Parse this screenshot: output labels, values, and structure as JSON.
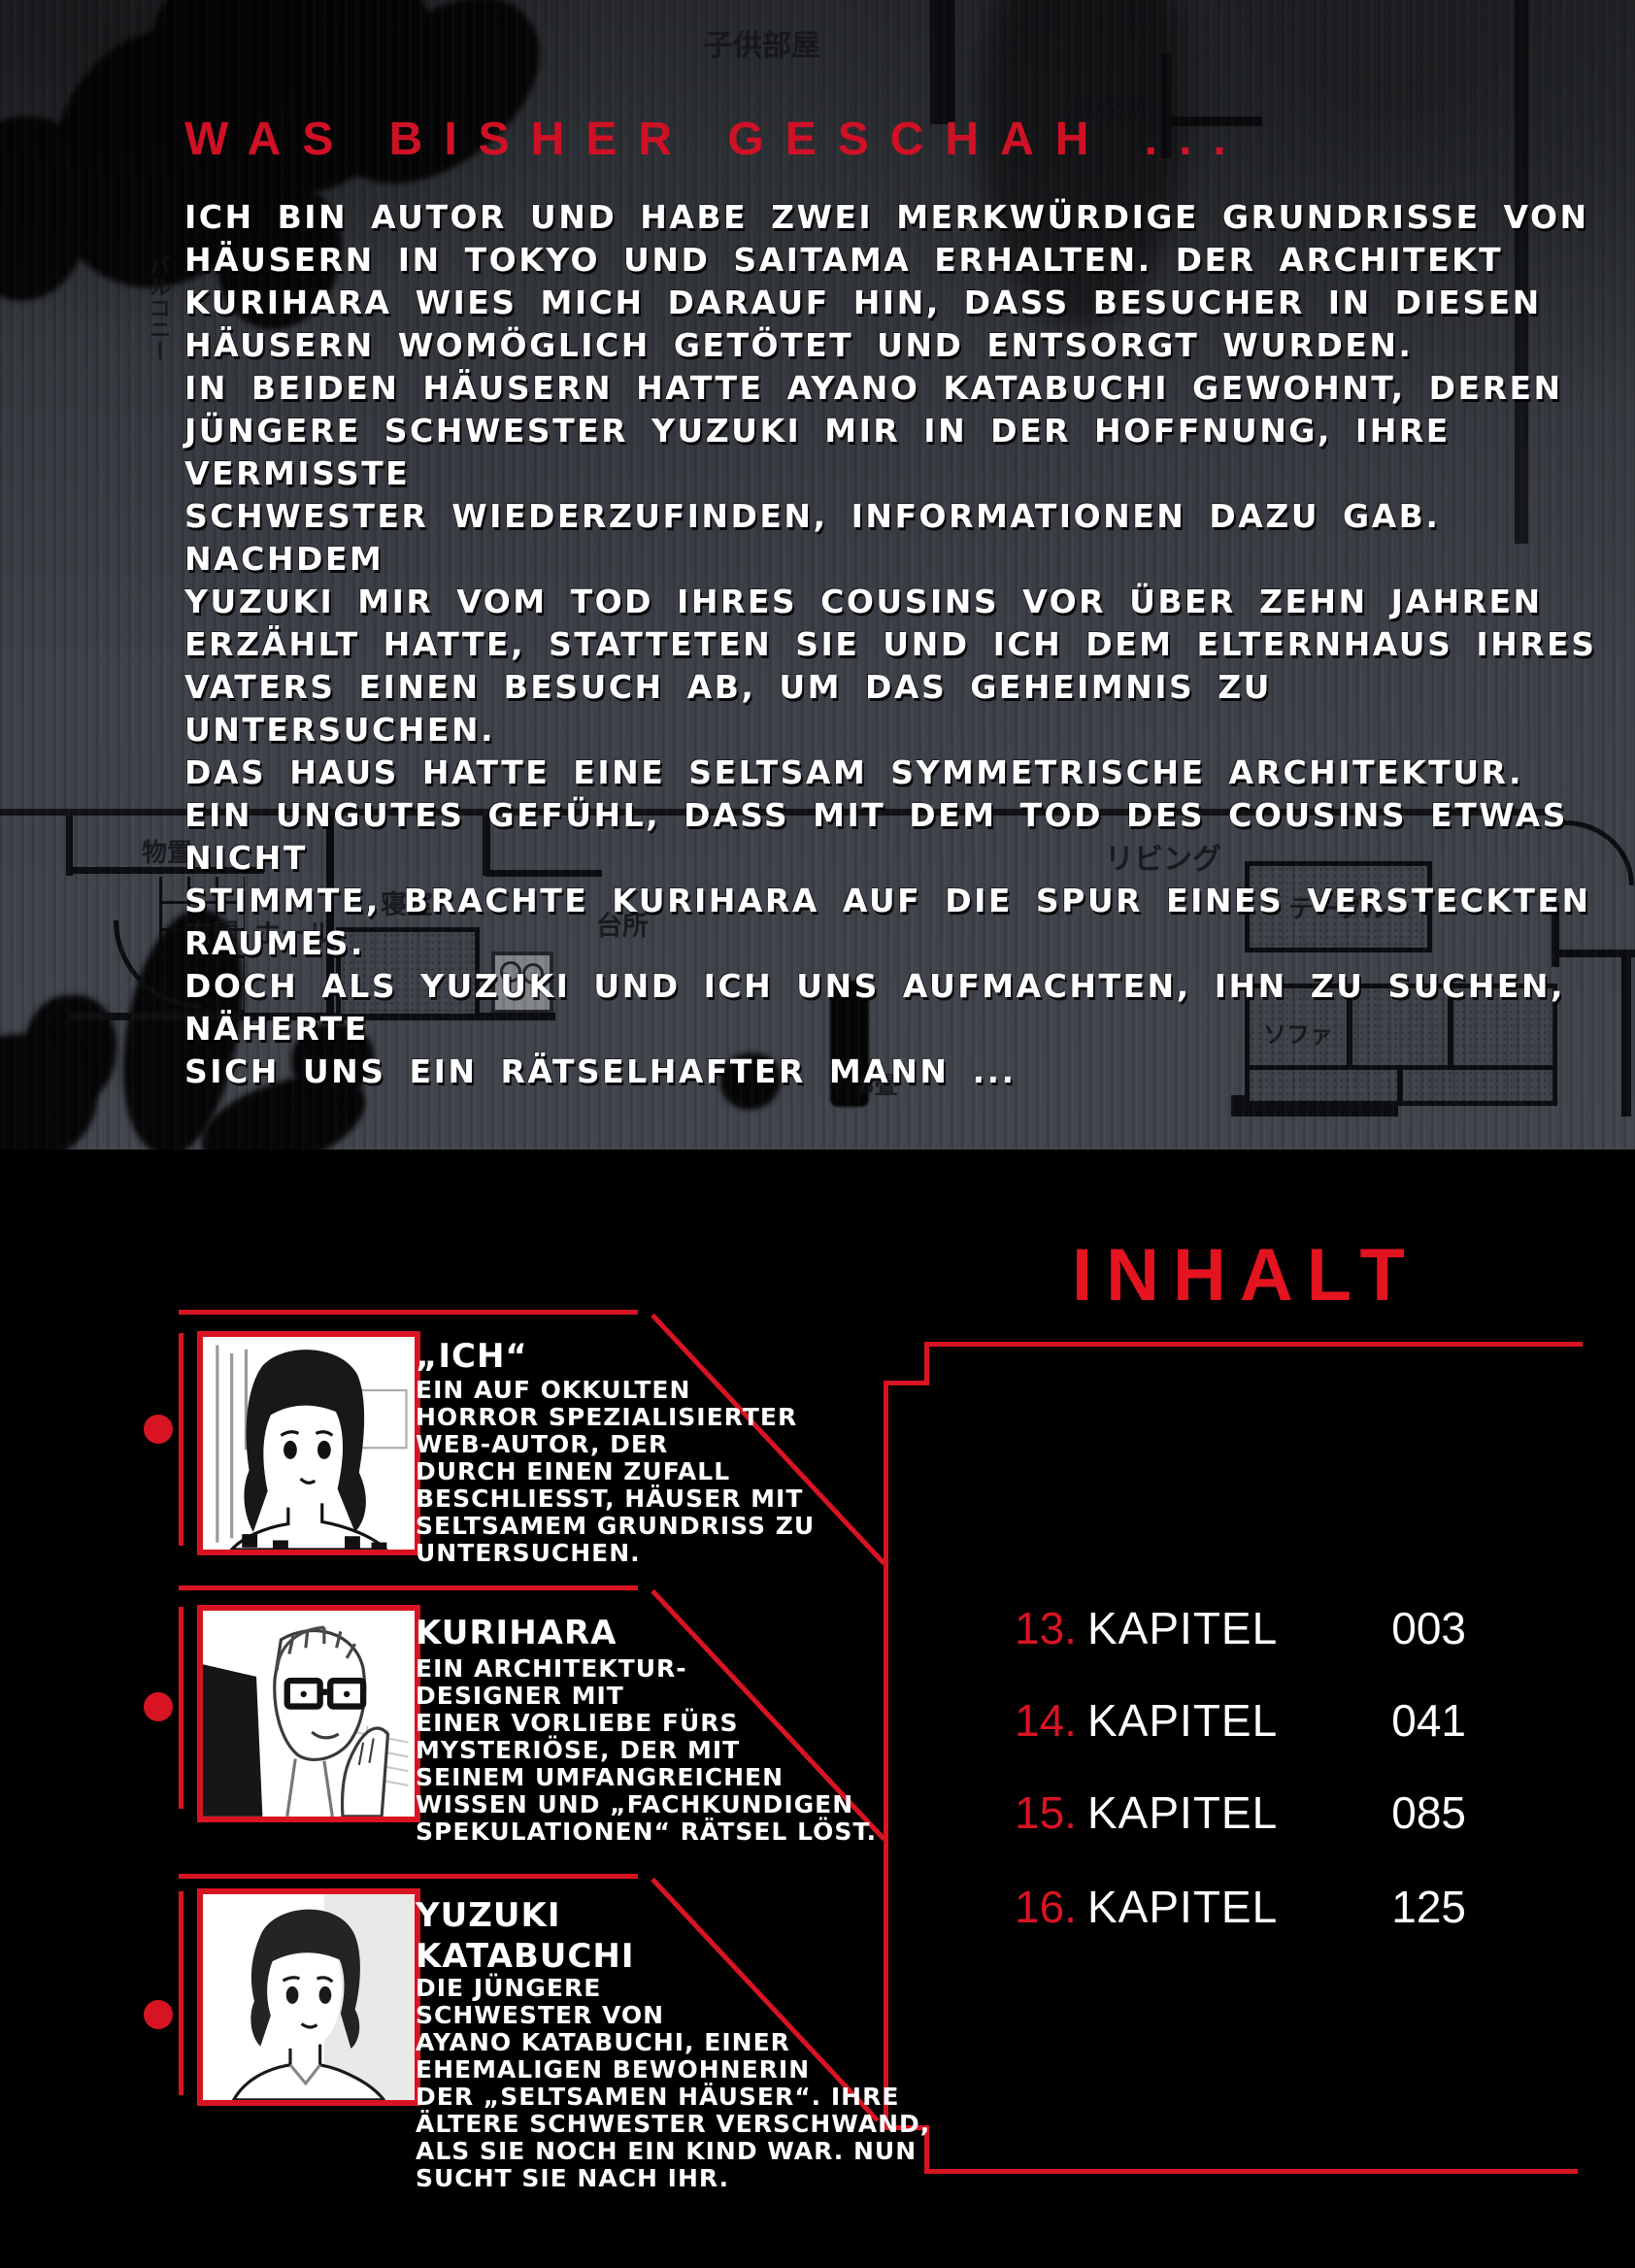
{
  "colors": {
    "accent_red": "#d81422",
    "title_red": "#cf1126",
    "inhalt_red": "#e3131f",
    "page_background": "#000000",
    "plan_background": "#3d4148",
    "text_white": "#ffffff"
  },
  "recap": {
    "title": "WAS BISHER GESCHAH ...",
    "body": "ICH BIN AUTOR UND HABE ZWEI MERKWÜRDIGE GRUNDRISSE VON\nHÄUSERN IN TOKYO UND SAITAMA ERHALTEN. DER ARCHITEKT\nKURIHARA WIES MICH DARAUF HIN, DASS BESUCHER IN DIESEN\nHÄUSERN WOMÖGLICH GETÖTET UND ENTSORGT WURDEN.\nIN BEIDEN HÄUSERN HATTE AYANO KATABUCHI GEWOHNT, DEREN\nJÜNGERE SCHWESTER YUZUKI MIR IN DER HOFFNUNG, IHRE VERMISSTE\nSCHWESTER WIEDERZUFINDEN, INFORMATIONEN DAZU GAB. NACHDEM\nYUZUKI MIR VOM TOD IHRES COUSINS VOR ÜBER ZEHN JAHREN\nERZÄHLT HATTE, STATTETEN SIE UND ICH DEM ELTERNHAUS IHRES\nVATERS EINEN BESUCH AB, UM DAS GEHEIMNIS ZU UNTERSUCHEN.\nDAS HAUS HATTE EINE SELTSAM SYMMETRISCHE ARCHITEKTUR.\nEIN UNGUTES GEFÜHL, DASS MIT DEM TOD DES COUSINS ETWAS NICHT\nSTIMMTE, BRACHTE KURIHARA AUF DIE SPUR EINES VERSTECKTEN RAUMES.\nDOCH ALS YUZUKI UND ICH UNS AUFMACHTEN, IHN ZU SUCHEN, NÄHERTE\nSICH UNS EIN RÄTSELHAFTER MANN ..."
  },
  "floorplan": {
    "labels": [
      "子供部屋",
      "脱衣所",
      "バルコニー",
      "物置",
      "玄関",
      "ホール",
      "寝室",
      "台所",
      "リビング",
      "テーブル",
      "ソファ",
      "8畳"
    ]
  },
  "contents": {
    "title": "INHALT",
    "chapters": [
      {
        "number": "13.",
        "label": "KAPITEL",
        "page": "003"
      },
      {
        "number": "14.",
        "label": "KAPITEL",
        "page": "041"
      },
      {
        "number": "15.",
        "label": "KAPITEL",
        "page": "085"
      },
      {
        "number": "16.",
        "label": "KAPITEL",
        "page": "125"
      }
    ]
  },
  "characters": [
    {
      "name": "„ICH“",
      "description": "EIN AUF OKKULTEN\nHORROR SPEZIALISIERTER\nWEB-AUTOR, DER\nDURCH EINEN ZUFALL\nBESCHLIESST, HÄUSER MIT\nSELTSAMEM GRUNDRISS ZU\nUNTERSUCHEN."
    },
    {
      "name": "KURIHARA",
      "description": "EIN ARCHITEKTUR-\nDESIGNER MIT\nEINER VORLIEBE FÜRS\nMYSTERIÖSE, DER MIT\nSEINEM UMFANGREICHEN\nWISSEN UND „FACHKUNDIGEN\nSPEKULATIONEN“ RÄTSEL LÖST."
    },
    {
      "name": "YUZUKI\nKATABUCHI",
      "description": "DIE JÜNGERE\nSCHWESTER VON\nAYANO KATABUCHI, EINER\nEHEMALIGEN BEWOHNERIN\nDER „SELTSAMEN HÄUSER“. IHRE\nÄLTERE SCHWESTER VERSCHWAND,\nALS SIE NOCH EIN KIND WAR. NUN\nSUCHT SIE NACH IHR."
    }
  ]
}
